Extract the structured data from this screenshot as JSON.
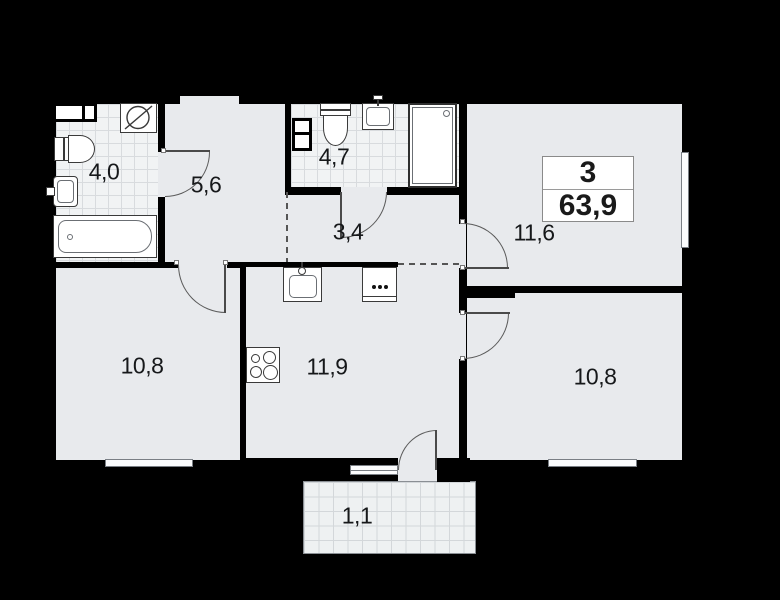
{
  "info_box": {
    "rooms_count": "3",
    "total_area": "63,9"
  },
  "rooms": [
    {
      "key": "bathroom-small",
      "label": "4,0"
    },
    {
      "key": "hallway",
      "label": "5,6"
    },
    {
      "key": "bathroom-large",
      "label": "4,7"
    },
    {
      "key": "corridor",
      "label": "3,4"
    },
    {
      "key": "living-room",
      "label": "11,6"
    },
    {
      "key": "bedroom-left",
      "label": "10,8"
    },
    {
      "key": "kitchen",
      "label": "11,9"
    },
    {
      "key": "bedroom-right",
      "label": "10,8"
    },
    {
      "key": "balcony",
      "label": "1,1"
    }
  ],
  "colors": {
    "background": "#000000",
    "floor": "#e8eaed",
    "tile": "#f1f3f4",
    "wall": "#000000",
    "window": "#fbfcfd",
    "label_text": "#16181a"
  }
}
